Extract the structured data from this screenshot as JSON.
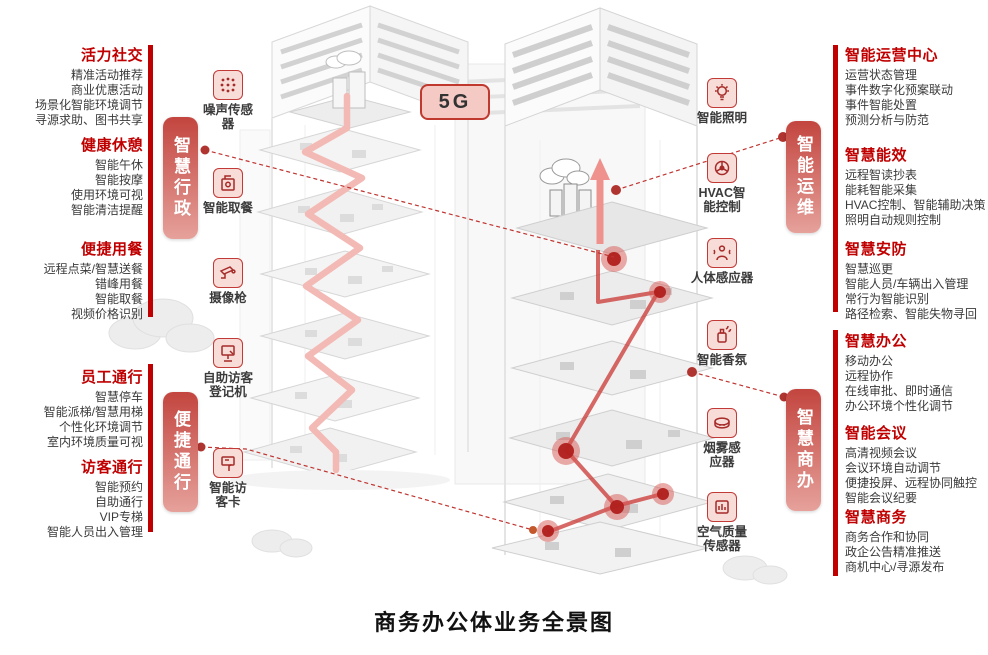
{
  "title": "商务办公体业务全景图",
  "badge": {
    "label": "5G"
  },
  "colors": {
    "accent_red": "#c00000",
    "tag_gradient_top": "#c3453f",
    "tag_gradient_bottom": "#e6a19b",
    "badge_bg": "#f5cac5",
    "badge_border": "#c0392f",
    "path_pink": "#f3b9b4",
    "path_red": "#c9302c",
    "sketch_gray": "#d9d9d9"
  },
  "left_panels": [
    {
      "heading": "活力社交",
      "items": [
        "精准活动推荐",
        "商业优惠活动",
        "场景化智能环境调节",
        "寻源求助、图书共享"
      ]
    },
    {
      "heading": "健康休憩",
      "items": [
        "智能午休",
        "智能按摩",
        "使用环境可视",
        "智能清洁提醒"
      ]
    },
    {
      "heading": "便捷用餐",
      "items": [
        "远程点菜/智慧送餐",
        "错峰用餐",
        "智能取餐",
        "视频价格识别"
      ]
    },
    {
      "heading": "员工通行",
      "items": [
        "智慧停车",
        "智能派梯/智慧用梯",
        "个性化环境调节",
        "室内环境质量可视"
      ]
    },
    {
      "heading": "访客通行",
      "items": [
        "智能预约",
        "自助通行",
        "VIP专梯",
        "智能人员出入管理"
      ]
    }
  ],
  "right_panels": [
    {
      "heading": "智能运营中心",
      "items": [
        "运营状态管理",
        "事件数字化预案联动",
        "事件智能处置",
        "预测分析与防范"
      ]
    },
    {
      "heading": "智慧能效",
      "items": [
        "远程智读抄表",
        "能耗智能采集",
        "HVAC控制、智能辅助决策",
        "照明自动规则控制"
      ]
    },
    {
      "heading": "智慧安防",
      "items": [
        "智慧巡更",
        "智能人员/车辆出入管理",
        "常行为智能识别",
        "路径检索、智能失物寻回"
      ]
    },
    {
      "heading": "智慧办公",
      "items": [
        "移动办公",
        "远程协作",
        "在线审批、即时通信",
        "办公环境个性化调节"
      ]
    },
    {
      "heading": "智能会议",
      "items": [
        "高清视频会议",
        "会议环境自动调节",
        "便捷投屏、远程协同触控",
        "智能会议纪要"
      ]
    },
    {
      "heading": "智慧商务",
      "items": [
        "商务合作和协同",
        "政企公告精准推送",
        "商机中心/寻源发布"
      ]
    }
  ],
  "vertical_tags": [
    {
      "label": "智慧行政"
    },
    {
      "label": "便捷通行"
    },
    {
      "label": "智能运维"
    },
    {
      "label": "智慧商办"
    }
  ],
  "sensors_left": [
    {
      "icon": "noise-sensor-icon",
      "label": "噪声传感\n器"
    },
    {
      "icon": "food-pickup-icon",
      "label": "智能取餐"
    },
    {
      "icon": "cctv-camera-icon",
      "label": "摄像枪"
    },
    {
      "icon": "visitor-kiosk-icon",
      "label": "自助访客\n登记机"
    },
    {
      "icon": "visitor-card-icon",
      "label": "智能访\n客卡"
    }
  ],
  "sensors_right": [
    {
      "icon": "smart-lighting-icon",
      "label": "智能照明"
    },
    {
      "icon": "hvac-control-icon",
      "label": "HVAC智\n能控制"
    },
    {
      "icon": "human-sensor-icon",
      "label": "人体感应器"
    },
    {
      "icon": "scent-diffuser-icon",
      "label": "智能香氛"
    },
    {
      "icon": "smoke-sensor-icon",
      "label": "烟雾感\n应器"
    },
    {
      "icon": "air-quality-sensor-icon",
      "label": "空气质量\n传感器"
    }
  ]
}
